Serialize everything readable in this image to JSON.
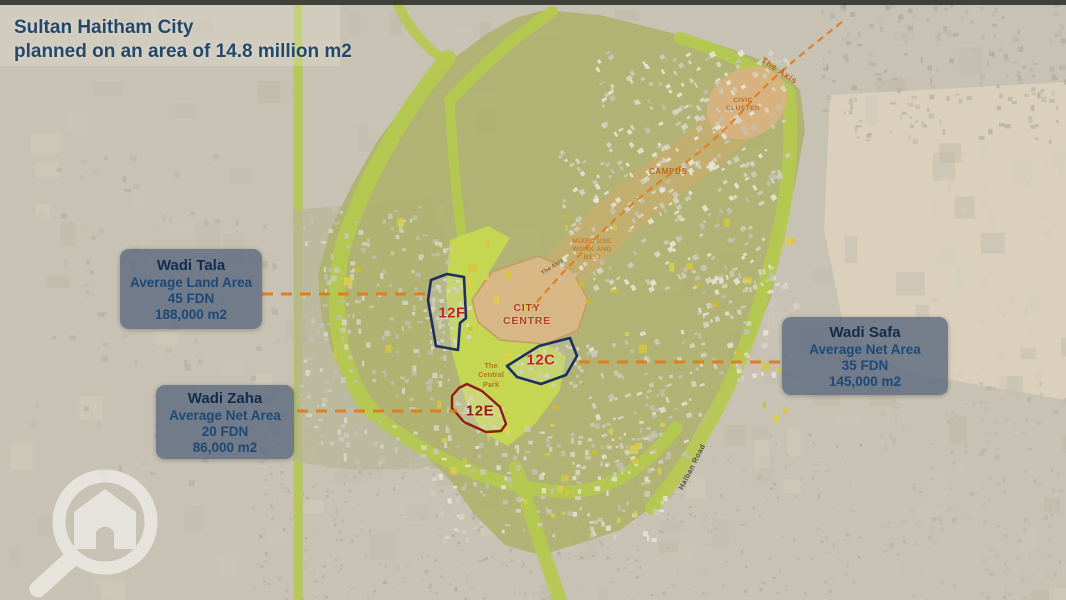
{
  "title": {
    "line1": "Sultan Haitham City",
    "line2": "planned on an area of 14.8 million m2"
  },
  "info_boxes": [
    {
      "title": "Wadi Tala",
      "area_type": "Average Land Area",
      "fdn": "45 FDN",
      "area": "188,000 m2"
    },
    {
      "title": "Wadi Zaha",
      "area_type": "Average Net Area",
      "fdn": "20 FDN",
      "area": "86,000 m2"
    },
    {
      "title": "Wadi Safa",
      "area_type": "Average Net Area",
      "fdn": "35 FDN",
      "area": "145,000 m2"
    }
  ],
  "map_labels": {
    "zone_12f": "12F",
    "zone_12c": "12C",
    "zone_12e": "12E",
    "city_centre_line1": "CITY",
    "city_centre_line2": "CENTRE",
    "campus": "CAMPUS",
    "civic_cluster_line1": "CIVIC",
    "civic_cluster_line2": "CLUSTER",
    "mixed_use_line1": "MIXED USE",
    "mixed_use_line2": "WORK AND",
    "mixed_use_line3": "RESI",
    "central_park_line1": "The",
    "central_park_line2": "Central",
    "central_park_line3": "Park",
    "the_axis": "The Axis",
    "axis_road_small": "The Axis",
    "halban_road": "Halban Road"
  },
  "colors": {
    "title_navy": "#24476b",
    "accent_orange": "#e07b1a",
    "zone_outline_navy": "#1c2e62",
    "zone_outline_red": "#8e1d12",
    "zone_label_red": "#ce1f1f",
    "map_label_orange": "#c06818",
    "city_centre_red": "#b04028",
    "infobox_bg": "rgba(88,102,126,0.78)",
    "infobox_title": "#142c4c",
    "infobox_text": "#1d4977",
    "park_green_band": "#b5c94e",
    "road_label_dark": "#56503e"
  },
  "logo": {
    "name": "house-search-logo"
  }
}
